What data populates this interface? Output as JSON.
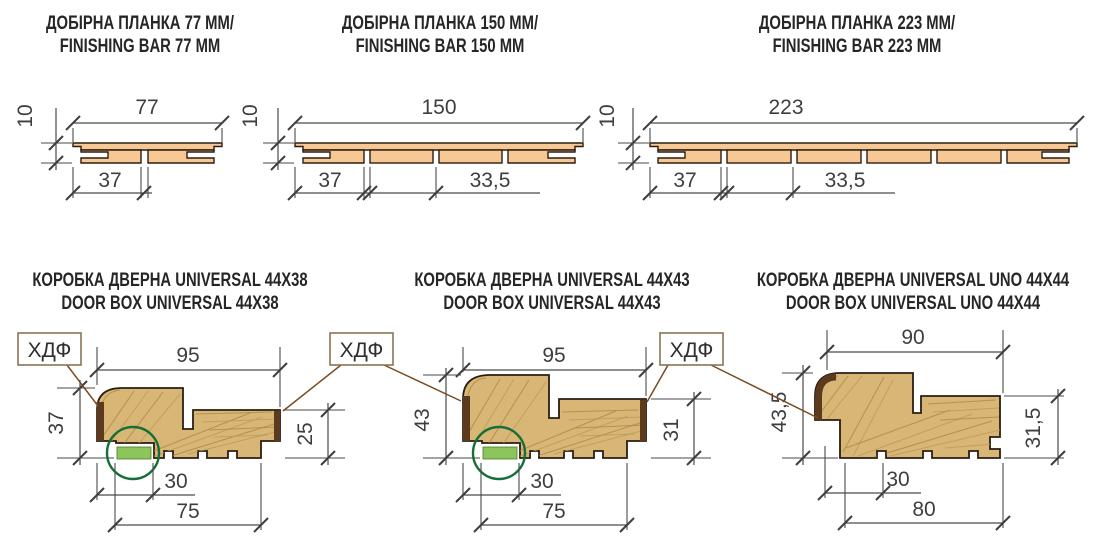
{
  "colors": {
    "bar_fill": "#F8C894",
    "wood_fill": "#D8B676",
    "wood_grain": "#AA8443",
    "hdf_edge": "#5C3A1E",
    "seal_green": "#8CC55B",
    "seal_circle_green": "#156F38",
    "leader_brown": "#7A4B22",
    "dim_line": "#4A4A4A",
    "text_dark": "#2F2F2F"
  },
  "finishing_bars": [
    {
      "title_uk": "ДОБІРНА ПЛАНКА 77 ММ/",
      "title_en": "FINISHING BAR 77 MM",
      "dim_width": "77",
      "dim_thickness": "10",
      "dim_offset": "37"
    },
    {
      "title_uk": "ДОБІРНА ПЛАНКА 150 ММ/",
      "title_en": "FINISHING BAR 150 MM",
      "dim_width": "150",
      "dim_thickness": "10",
      "dim_offset": "37",
      "dim_step": "33,5"
    },
    {
      "title_uk": "ДОБІРНА ПЛАНКА 223 ММ/",
      "title_en": "FINISHING BAR 223 MM",
      "dim_width": "223",
      "dim_thickness": "10",
      "dim_offset": "37",
      "dim_step": "33,5"
    }
  ],
  "door_boxes": [
    {
      "title_uk": "КОРОБКА ДВЕРНА UNIVERSAL 44X38",
      "title_en": "DOOR BOX UNIVERSAL 44X38",
      "dim_top": "95",
      "dim_left": "37",
      "dim_right": "25",
      "dim_seal": "30",
      "dim_bottom": "75"
    },
    {
      "title_uk": "КОРОБКА ДВЕРНА UNIVERSAL 44X43",
      "title_en": "DOOR BOX UNIVERSAL 44X43",
      "dim_top": "95",
      "dim_left": "43",
      "dim_right": "31",
      "dim_seal": "30",
      "dim_bottom": "75"
    },
    {
      "title_uk": "КОРОБКА ДВЕРНА UNIVERSAL UNO 44X44",
      "title_en": "DOOR BOX UNIVERSAL UNO 44X44",
      "dim_top": "90",
      "dim_left": "43,5",
      "dim_right": "31,5",
      "dim_seal": "30",
      "dim_bottom": "80"
    }
  ],
  "hdf_callouts": [
    {
      "label": "ХДФ"
    },
    {
      "label": "ХДФ"
    },
    {
      "label": "ХДФ"
    }
  ]
}
